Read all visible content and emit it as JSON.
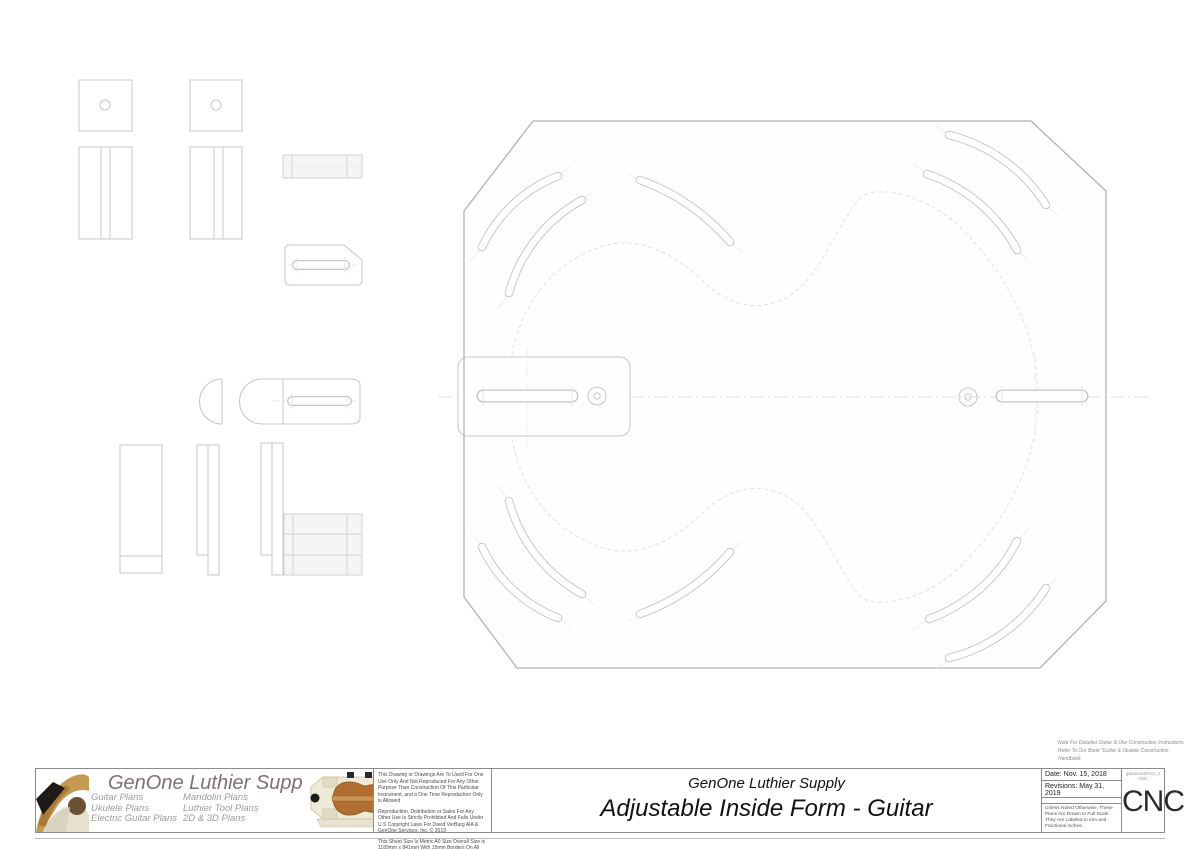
{
  "note": {
    "line1": "Note For Detailed Guitar & Uke Construction Instructions",
    "line2": "Refer To Our Book \"Guitar & Ukulele Construction",
    "line3": "Handbook"
  },
  "title_block": {
    "brand": {
      "name": "GenOne Luthier Supplies",
      "categories_col1": [
        "Guitar Plans",
        "Ukulele Plans",
        "Electric Guitar Plans"
      ],
      "categories_col2": [
        "Mandolin Plans",
        "Luthier Tool Plans",
        "2D & 3D Plans"
      ]
    },
    "legal": {
      "p1": "This Drawing or Drawings Are To Used For One Use Only And Not Reproduced For Any Other Purpose Than Construction Of This Particular Instrument, and a One Time Reproduction Only is Allowed",
      "p2": "Reproduction, Distribution or Sales For Any Other Use Is Strictly Prohibited And Falls Under U.S Copyright Laws For David VerBurg AIA & GenOne Services, Inc. © 2019",
      "p3": "This Sheet Size Is Metric A0 Size Overall Size is 1189mm x 841mm With 15mm Borders On All Sides. For USA Customers Print On Architectural \"E\" (36\" x 48\") Without Resizing For 1:1 Printout."
    },
    "title": {
      "company": "GenOne Luthier Supply",
      "drawing": "Adjustable Inside Form - Guitar"
    },
    "info": {
      "date": "Date: Nov. 15, 2018",
      "revisions": "Revisions: May 31, 2019",
      "scale_note": "Unless Noted Otherwise, These Plans Are Drawn to Full Scale. They Are Labeled in mm and Fractional Inches."
    },
    "cnc": {
      "filename": "guitarinsideform_2 CNC",
      "label": "CNC"
    }
  },
  "colors": {
    "form_outline": "#b3b3b3",
    "part_line": "#c7c7c7",
    "faint_line": "#e0e0e0",
    "brand_text": "#7d7173",
    "category_text": "#a09a9a",
    "title_text": "#111111"
  }
}
